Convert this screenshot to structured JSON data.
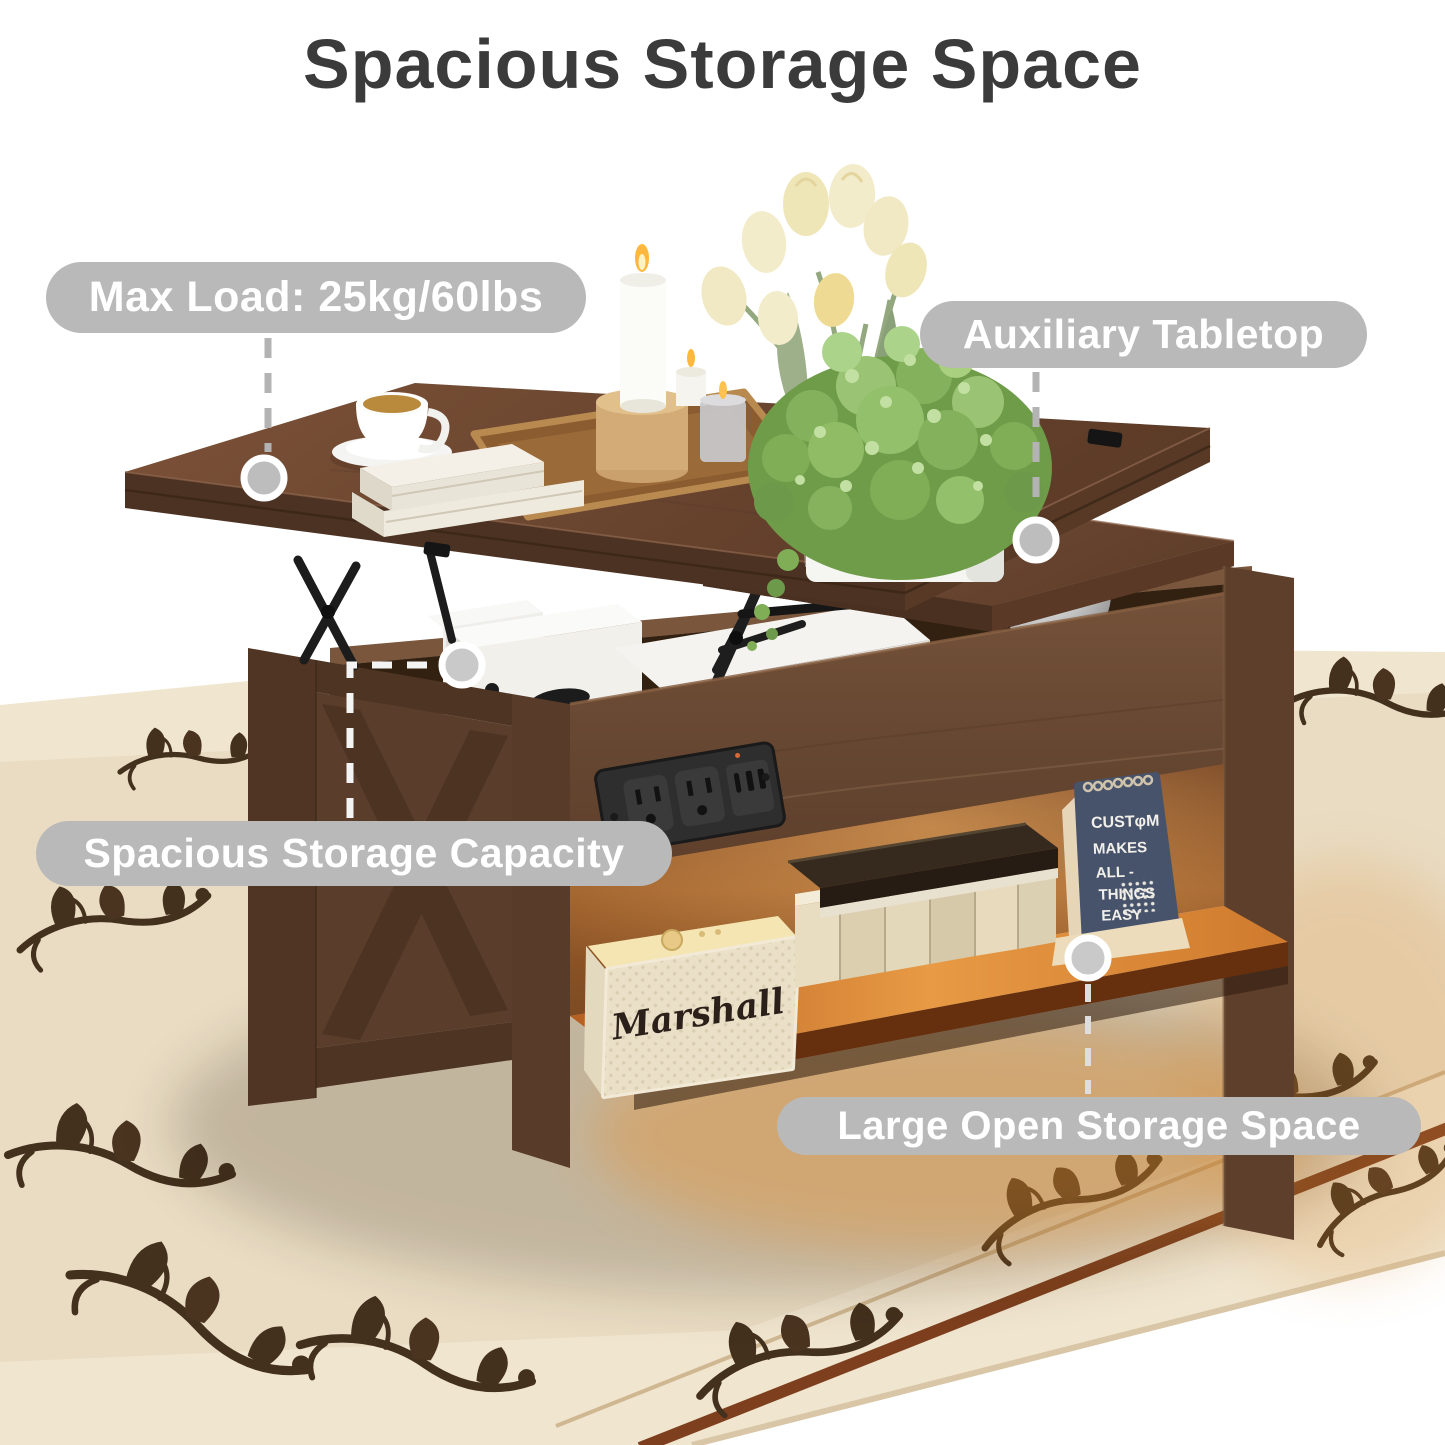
{
  "title": "Spacious Storage Space",
  "callouts": {
    "max_load": {
      "label": "Max Load: 25kg/60lbs"
    },
    "auxiliary": {
      "label": "Auxiliary Tabletop"
    },
    "capacity": {
      "label": "Spacious Storage Capacity"
    },
    "open_storage": {
      "label": "Large Open Storage Space"
    }
  },
  "scene": {
    "speaker_logo": "Marshall",
    "calendar": {
      "lines": [
        "CUSTφM",
        "MAKES",
        "ALL -",
        "THINGS",
        "EASY"
      ]
    }
  },
  "colors": {
    "pill_bg": "#b9b9b9",
    "pill_text": "#ffffff",
    "title_text": "#3b3b3b",
    "wood_top": "#6a452f",
    "wood_front": "#6b4a34",
    "wood_side": "#5a3d2b",
    "shelf_glow": "#e89a44",
    "rug_base": "#f0e5cf",
    "rug_pattern": "#43301d",
    "rug_border_stripe": "#7e3f1e",
    "calendar_cover": "#47536b",
    "speaker_body": "#ece3cb",
    "connector_gray": "#b3b3b3",
    "connector_white": "#f4f4f4"
  }
}
